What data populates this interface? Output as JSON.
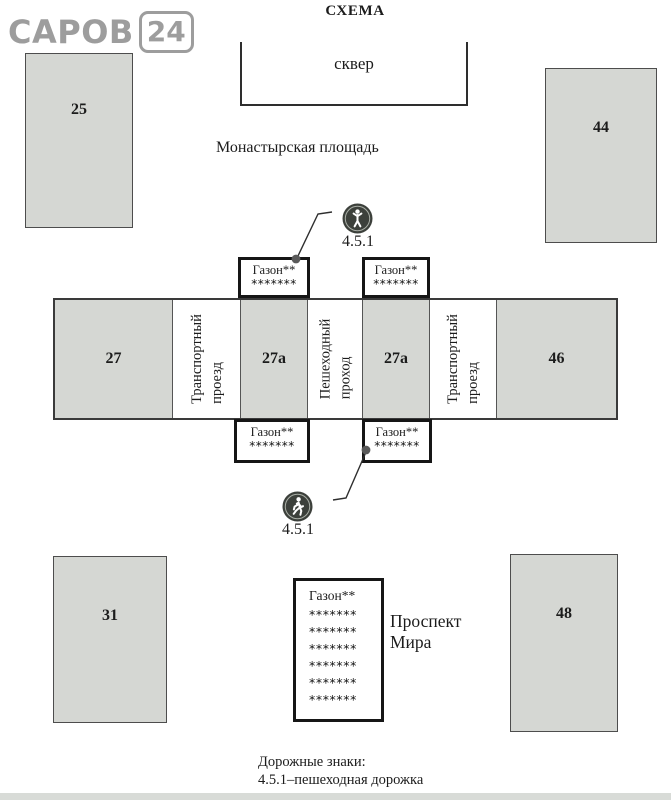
{
  "title": "СХЕМА",
  "logo": {
    "text": "САРОВ",
    "badge": "24"
  },
  "park": {
    "label": "сквер"
  },
  "labels": {
    "square": "Монастырская площадь",
    "avenue_line1": "Проспект",
    "avenue_line2": "Мира"
  },
  "buildings": {
    "b25": "25",
    "b44": "44",
    "b27": "27",
    "b27a_left": "27а",
    "b27a_right": "27а",
    "b46": "46",
    "b31": "31",
    "b48": "48"
  },
  "passages": {
    "transport_line1": "Транспортный",
    "transport_line2": "проезд",
    "pedestrian_line1": "Пешеходный",
    "pedestrian_line2": "проход"
  },
  "lawn": {
    "label": "Газон**",
    "stars": "*******"
  },
  "big_lawn": {
    "label": "Газон**",
    "stars": "*******"
  },
  "signs": {
    "top_label": "4.5.1",
    "bottom_label": "4.5.1"
  },
  "legend": {
    "line1": "Дорожные знаки:",
    "line2": "4.5.1–пешеходная дорожка"
  },
  "colors": {
    "building_fill": "#d5d7d3",
    "box_border": "#161616",
    "sign_circle": "#3c403b",
    "logo_gray": "#9d9d9d"
  }
}
